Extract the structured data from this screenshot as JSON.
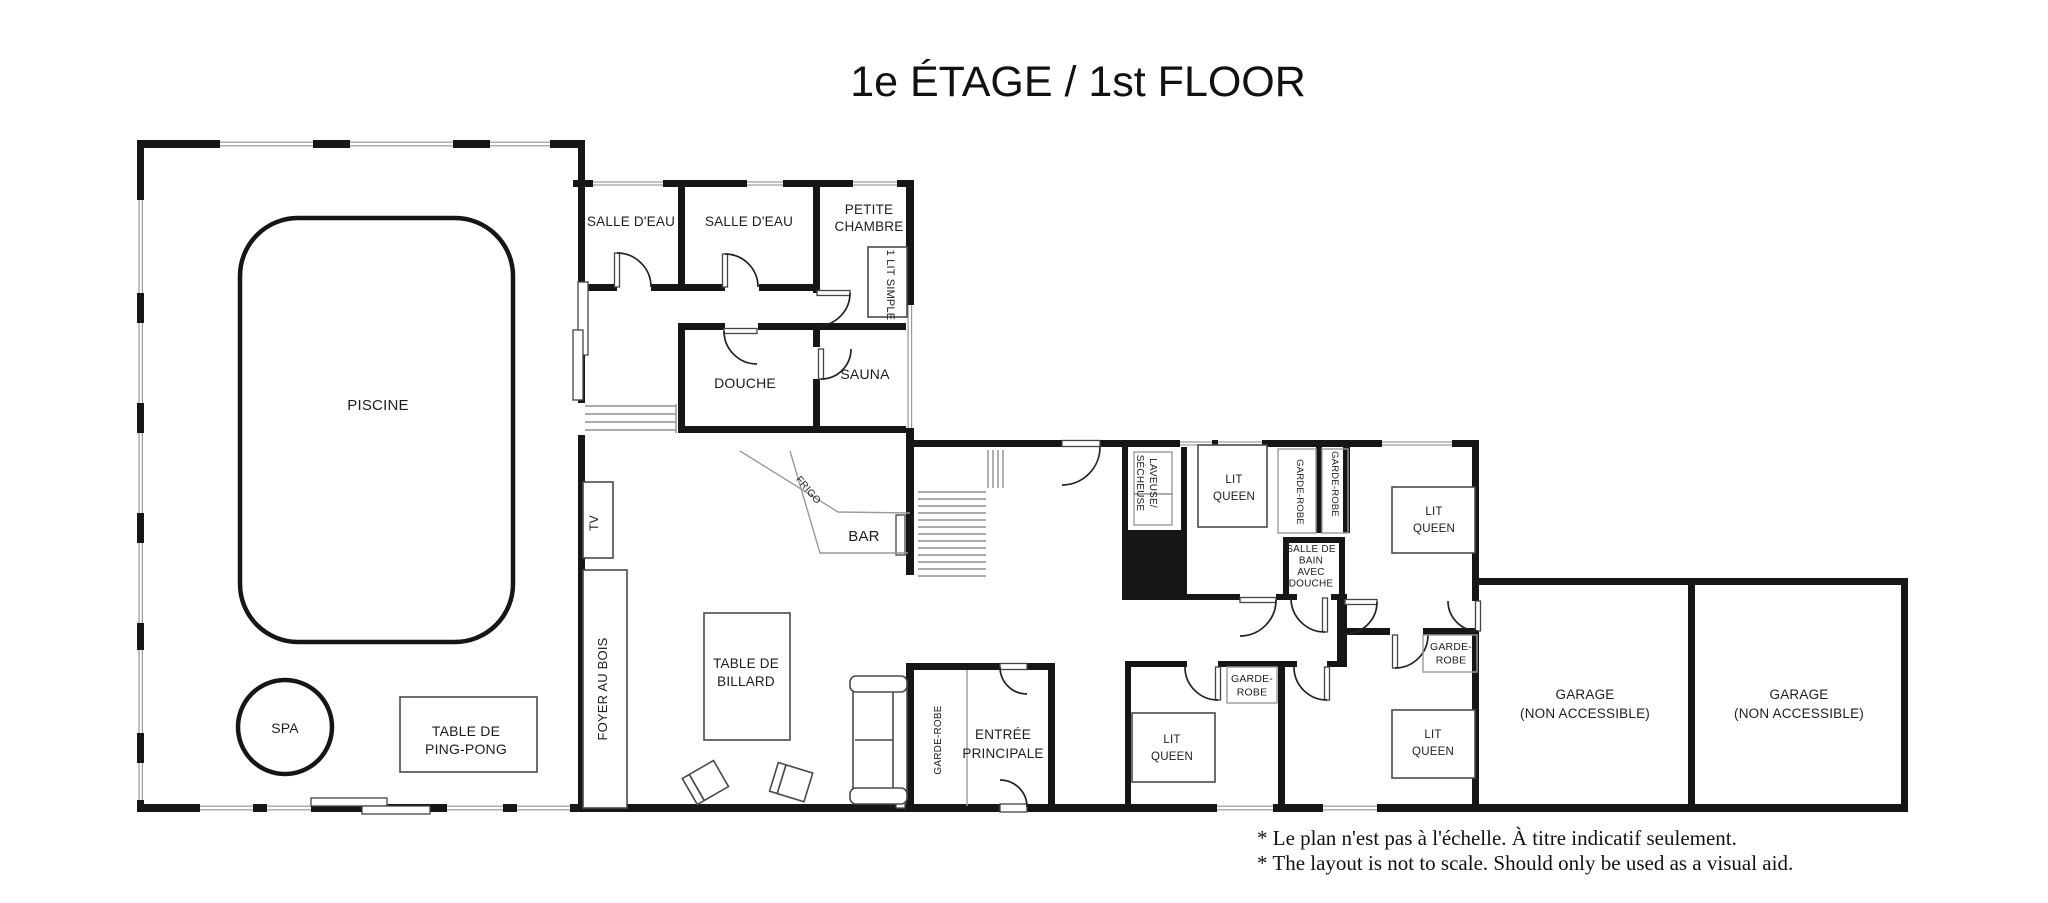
{
  "title": "1e ÉTAGE / 1st FLOOR",
  "notes": {
    "line1": "* Le plan n'est pas à l'échelle. À titre indicatif seulement.",
    "line2": "* The layout is not to scale. Should only be used as a visual aid."
  },
  "colors": {
    "wall": "#161616",
    "window": "#9a9a9a",
    "furniture": "#4a4a4a",
    "stairs": "#8f8f8f",
    "text": "#1c1c1c",
    "background": "#ffffff"
  },
  "labels": [
    {
      "id": "piscine-label",
      "x": 378,
      "y": 410,
      "size": 15,
      "lines": [
        "PISCINE"
      ]
    },
    {
      "id": "spa-label",
      "x": 285,
      "y": 733,
      "size": 14,
      "lines": [
        "SPA"
      ]
    },
    {
      "id": "ping-pong-label",
      "x": 466,
      "y": 736,
      "size": 14,
      "lh": 18,
      "lines": [
        "TABLE DE",
        "PING-PONG"
      ]
    },
    {
      "id": "salle-eau-1-label",
      "x": 631,
      "y": 226,
      "size": 13.5,
      "lines": [
        "SALLE D'EAU"
      ]
    },
    {
      "id": "salle-eau-2-label",
      "x": 749,
      "y": 226,
      "size": 13.5,
      "lines": [
        "SALLE D'EAU"
      ]
    },
    {
      "id": "petite-chambre-label",
      "x": 869,
      "y": 214,
      "size": 13.5,
      "lh": 17,
      "lines": [
        "PETITE",
        "CHAMBRE"
      ]
    },
    {
      "id": "lit-simple-label",
      "x": 887,
      "y": 285,
      "rot": 90,
      "size": 11,
      "lines": [
        "1 LIT SIMPLE"
      ]
    },
    {
      "id": "douche-label",
      "x": 745,
      "y": 388,
      "size": 14,
      "lines": [
        "DOUCHE"
      ]
    },
    {
      "id": "sauna-label",
      "x": 865,
      "y": 379,
      "size": 14,
      "lines": [
        "SAUNA"
      ]
    },
    {
      "id": "tv-label",
      "x": 598,
      "y": 523,
      "rot": -90,
      "size": 12,
      "lines": [
        "TV"
      ]
    },
    {
      "id": "foyer-au-bois-label",
      "x": 607,
      "y": 689,
      "rot": -90,
      "size": 13,
      "lines": [
        "FOYER AU BOIS"
      ]
    },
    {
      "id": "frigo-label",
      "x": 806,
      "y": 492,
      "rot": 50,
      "size": 10,
      "lines": [
        "FRIGO"
      ]
    },
    {
      "id": "bar-label",
      "x": 864,
      "y": 541,
      "size": 15,
      "lines": [
        "BAR"
      ]
    },
    {
      "id": "billard-label",
      "x": 746,
      "y": 668,
      "size": 13.5,
      "lh": 18,
      "lines": [
        "TABLE DE",
        "BILLARD"
      ]
    },
    {
      "id": "garde-robe-entree-label",
      "x": 941,
      "y": 740,
      "rot": -90,
      "size": 10,
      "lines": [
        "GARDE-ROBE"
      ]
    },
    {
      "id": "entree-principale-label",
      "x": 1003,
      "y": 739,
      "size": 13.5,
      "lh": 19,
      "lines": [
        "ENTRÉE",
        "PRINCIPALE"
      ]
    },
    {
      "id": "laveuse-secheuse-label",
      "x": 1150,
      "y": 483,
      "rot": 90,
      "size": 10,
      "lh": 13,
      "lines": [
        "LAVEUSE/",
        "SÉCHEUSE"
      ]
    },
    {
      "id": "lit-queen-1-label",
      "x": 1234,
      "y": 483,
      "size": 11.5,
      "lh": 17,
      "lines": [
        "LIT",
        "QUEEN"
      ]
    },
    {
      "id": "garde-robe-1-label",
      "x": 1297,
      "y": 492,
      "rot": 90,
      "size": 9.5,
      "lines": [
        "GARDE-ROBE"
      ]
    },
    {
      "id": "garde-robe-2-label",
      "x": 1332,
      "y": 484,
      "rot": 90,
      "size": 9.5,
      "lines": [
        "GARDE-ROBE"
      ]
    },
    {
      "id": "salle-de-bain-label",
      "x": 1311,
      "y": 552,
      "size": 10,
      "lh": 11.5,
      "lines": [
        "SALLE DE",
        "BAIN",
        "AVEC",
        "DOUCHE"
      ]
    },
    {
      "id": "lit-queen-2-label",
      "x": 1434,
      "y": 515,
      "size": 11.5,
      "lh": 17,
      "lines": [
        "LIT",
        "QUEEN"
      ]
    },
    {
      "id": "garde-robe-4-label",
      "x": 1451,
      "y": 650,
      "size": 10.5,
      "lh": 13.5,
      "lines": [
        "GARDE-",
        "ROBE"
      ]
    },
    {
      "id": "garde-robe-3-label",
      "x": 1252,
      "y": 682,
      "size": 10.5,
      "lh": 13.5,
      "lines": [
        "GARDE-",
        "ROBE"
      ]
    },
    {
      "id": "lit-queen-3-label",
      "x": 1172,
      "y": 743,
      "size": 11.5,
      "lh": 17,
      "lines": [
        "LIT",
        "QUEEN"
      ]
    },
    {
      "id": "lit-queen-4-label",
      "x": 1433,
      "y": 738,
      "size": 11.5,
      "lh": 17,
      "lines": [
        "LIT",
        "QUEEN"
      ]
    },
    {
      "id": "garage-1-label",
      "x": 1585,
      "y": 699,
      "size": 13.5,
      "lh": 19,
      "lines": [
        "GARAGE",
        "(NON ACCESSIBLE)"
      ]
    },
    {
      "id": "garage-2-label",
      "x": 1799,
      "y": 699,
      "size": 13.5,
      "lh": 19,
      "lines": [
        "GARAGE",
        "(NON ACCESSIBLE)"
      ]
    }
  ]
}
